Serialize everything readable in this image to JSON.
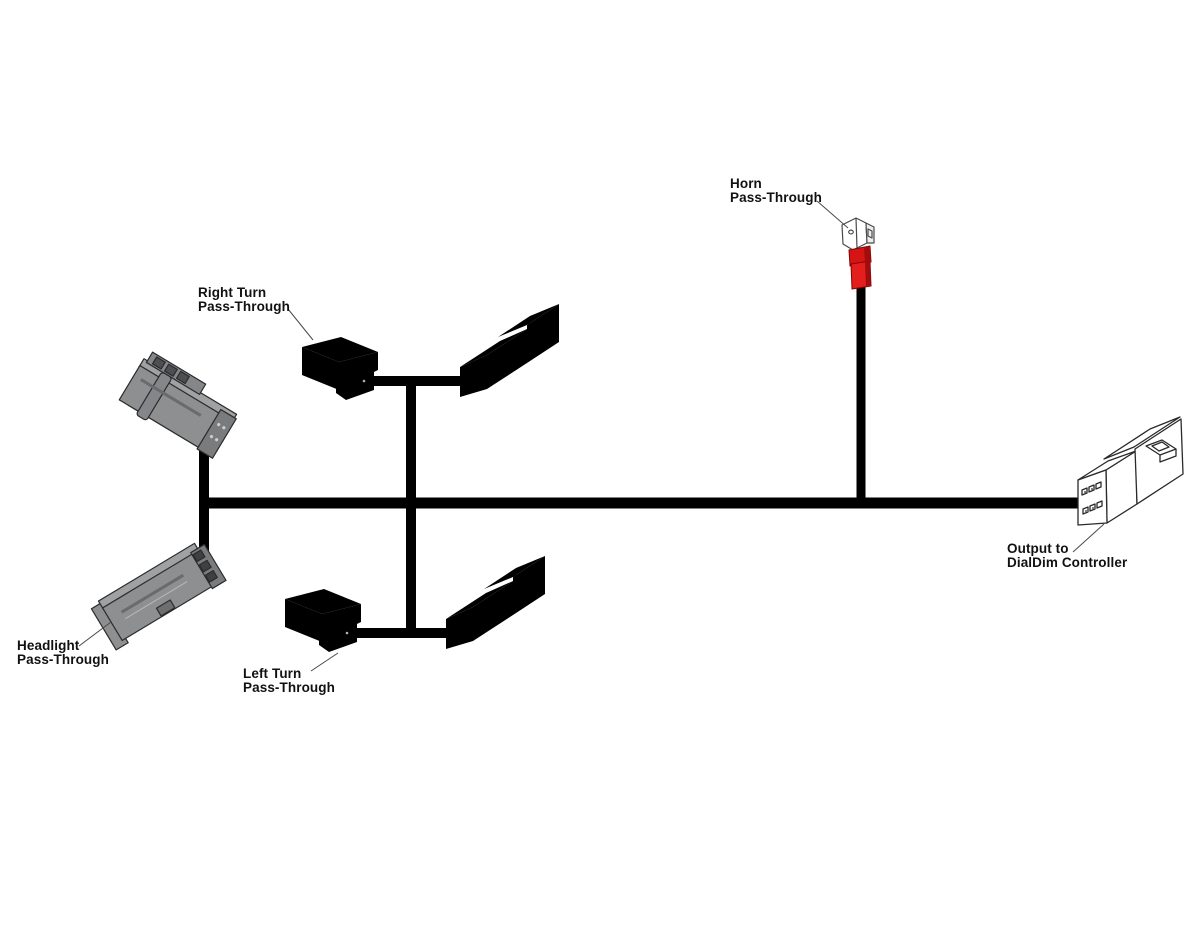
{
  "diagram": {
    "kind": "wiring-harness-diagram",
    "labels": {
      "horn": {
        "line1": "Horn",
        "line2": "Pass-Through"
      },
      "right_turn": {
        "line1": "Right Turn",
        "line2": "Pass-Through"
      },
      "headlight": {
        "line1": "Headlight",
        "line2": "Pass-Through"
      },
      "left_turn": {
        "line1": "Left Turn",
        "line2": "Pass-Through"
      },
      "output": {
        "line1": "Output to",
        "line2": "DialDim Controller"
      }
    },
    "components": [
      {
        "id": "horn-terminal",
        "icon": "red-spade-terminal-icon"
      },
      {
        "id": "right-turn-female-connector",
        "icon": "white-female-connector-icon"
      },
      {
        "id": "right-turn-male-connector",
        "icon": "white-male-connector-icon"
      },
      {
        "id": "left-turn-female-connector",
        "icon": "white-female-connector-icon"
      },
      {
        "id": "left-turn-male-connector",
        "icon": "white-male-connector-icon"
      },
      {
        "id": "headlight-connector-upper",
        "icon": "gray-sealed-connector-icon"
      },
      {
        "id": "headlight-connector-lower",
        "icon": "gray-sealed-connector-icon"
      },
      {
        "id": "dialdim-output-connector",
        "icon": "white-6pin-connector-icon"
      }
    ],
    "colors": {
      "background": "#ffffff",
      "wire": "#000000",
      "line_art_dark": "#2a2a2a",
      "line_art_light": "#b0b0b0",
      "connector_gray": "#8e8f90",
      "connector_gray_dark": "#7a7b7d",
      "terminal_red": "#d51414",
      "terminal_red_shade": "#a30c0c",
      "label_text": "#111111",
      "leader_line": "#4a4a4a"
    }
  }
}
